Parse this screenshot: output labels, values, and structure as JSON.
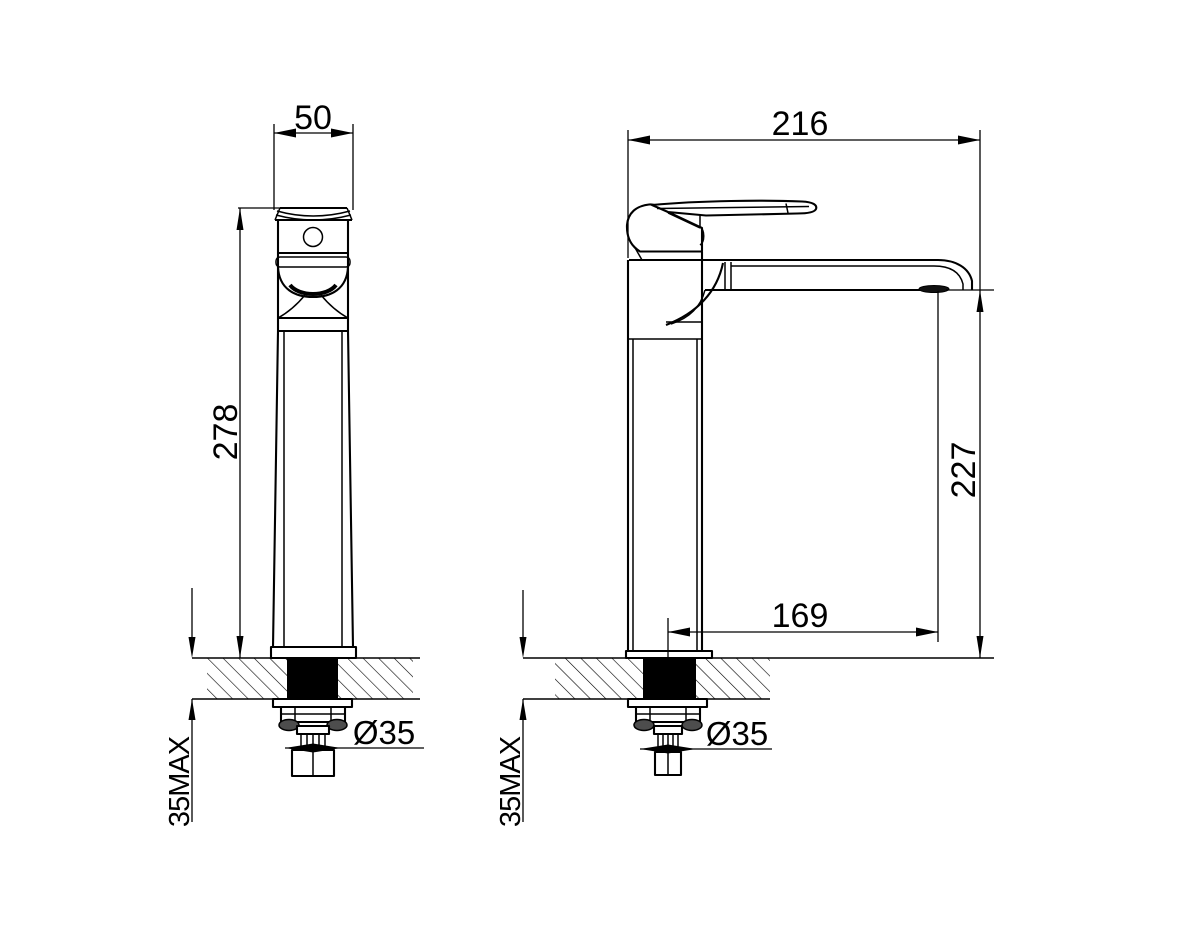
{
  "drawing": {
    "type": "technical-dimension-drawing",
    "subject": "tall single-lever basin mixer tap, front and side views",
    "units": "mm",
    "line_color": "#000000",
    "background_color": "#ffffff",
    "lug_fill_color": "#4d4d4d",
    "front_view": {
      "handle_width": "50",
      "height_above_deck": "278",
      "mounting_hole_diameter": "Ø35",
      "max_deck_thickness": "35MAX"
    },
    "side_view": {
      "overall_depth": "216",
      "spout_height": "227",
      "spout_reach": "169",
      "mounting_hole_diameter": "Ø35",
      "max_deck_thickness": "35MAX"
    }
  }
}
